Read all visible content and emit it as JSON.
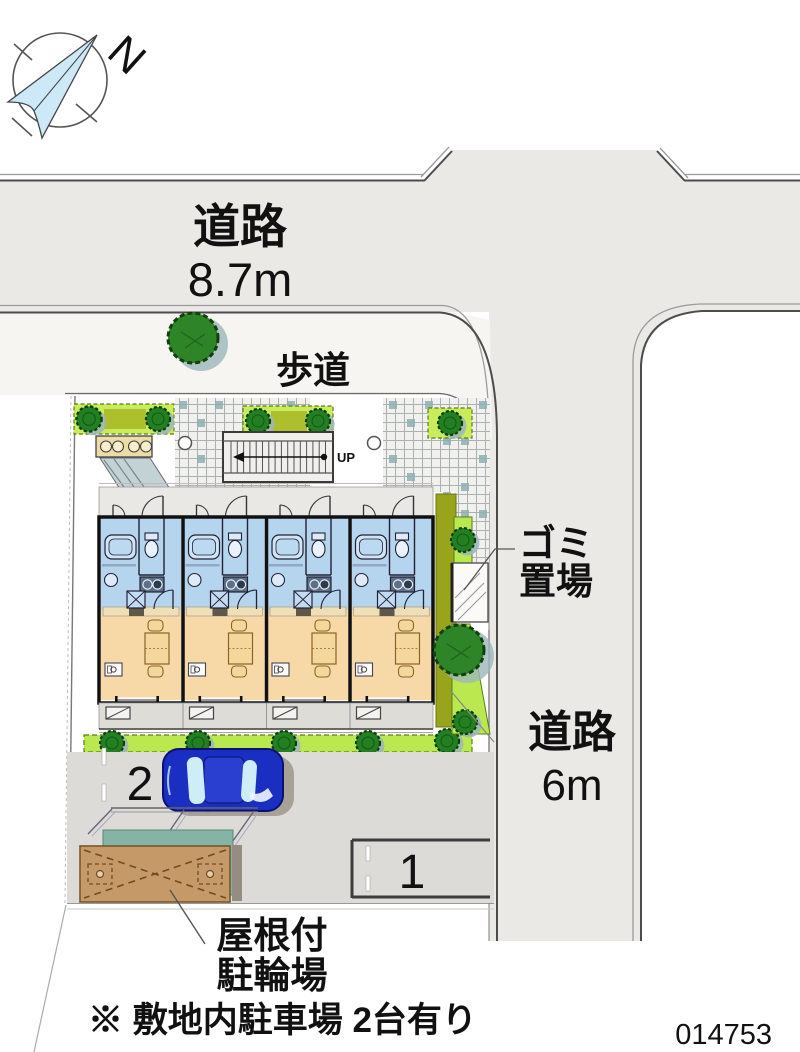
{
  "compass": {
    "north": "N"
  },
  "roads": {
    "top": {
      "name": "道路",
      "width": "8.7m"
    },
    "right": {
      "name": "道路",
      "width": "6m"
    },
    "sidewalk_label": "歩道"
  },
  "site": {
    "stairs_up_label": "UP",
    "garbage_label": {
      "line1": "ゴミ",
      "line2": "置場"
    },
    "bicycle_shed_label": {
      "line1": "屋根付",
      "line2": "駐輪場"
    },
    "parking": {
      "spot1": "1",
      "spot2": "2"
    }
  },
  "footnote": "※ 敷地内駐車場 2台有り",
  "plan_id": "014753",
  "colors": {
    "road": "#ebe9e6",
    "sidewalk": "#f6f5f2",
    "unit_wet_area": "#b5d5ef",
    "unit_room": "#f6d9a7",
    "hedge": "#b9e94f",
    "tree_green": "#2e8527",
    "tree_shadow": "#9cb6ba",
    "shed_roof": "#c69a68",
    "shed_canopy": "#85b3a6",
    "car": "#1b2ec2",
    "pavement": "#dcdbd7",
    "olive_hedge": "#98a41c"
  }
}
